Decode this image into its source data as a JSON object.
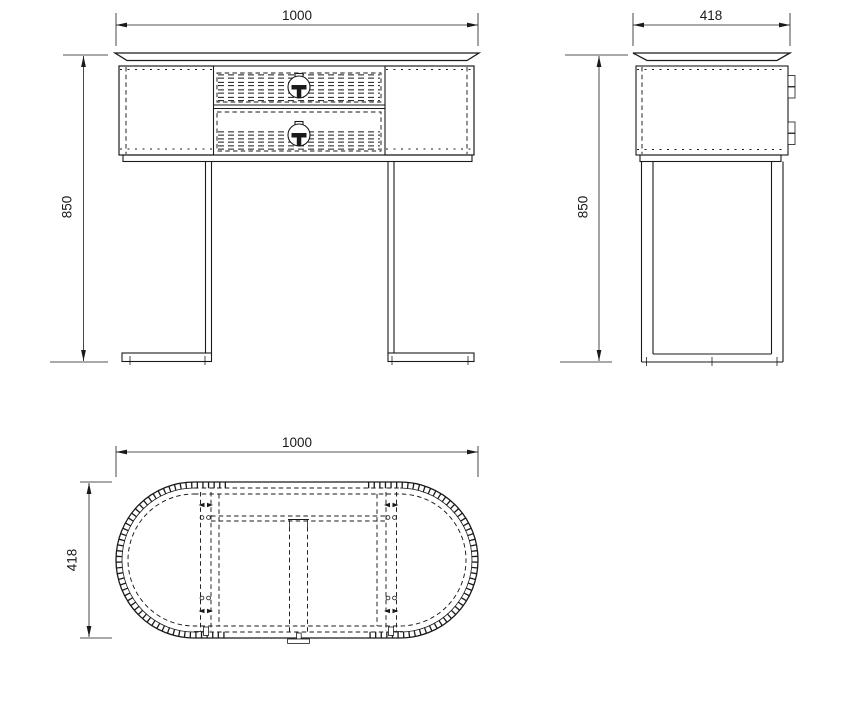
{
  "canvas": {
    "background": "#ffffff",
    "line_color": "#1a1a1a"
  },
  "views": {
    "front": {
      "width": "1000",
      "height": "850"
    },
    "side": {
      "width": "418",
      "height": "850"
    },
    "top": {
      "width": "1000",
      "depth": "418"
    }
  }
}
